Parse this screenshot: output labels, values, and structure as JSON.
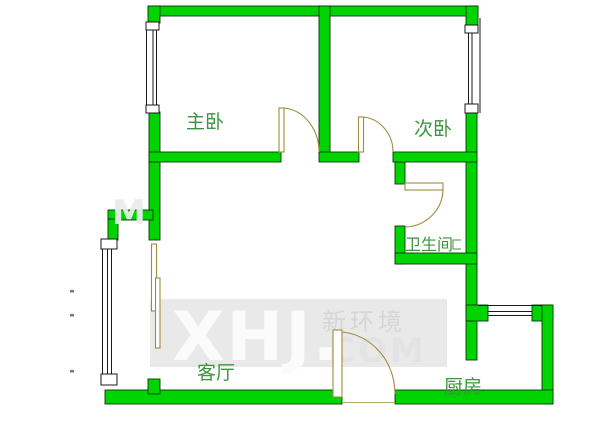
{
  "page": {
    "type": "apartment-floor-plan",
    "background_color": "#ffffff"
  },
  "floor_plan": {
    "rooms": {
      "master_bedroom": {
        "label": "主卧"
      },
      "second_bedroom": {
        "label": "次卧"
      },
      "bathroom": {
        "label": "卫生间"
      },
      "living_room": {
        "label": "客厅"
      },
      "kitchen": {
        "label": "厨房"
      }
    },
    "colors": {
      "wall_fill": "#00d400",
      "wall_outline": "#063a06",
      "door_arc": "#a08a3e",
      "window_line": "#1a1a1a",
      "label_green": "#3d953d",
      "watermark_band": "#e9e9e9"
    }
  },
  "watermark": {
    "brand": "XHJ.",
    "company_cn": "新环境",
    "suffix": "COM",
    "faint_fragment": "M"
  }
}
